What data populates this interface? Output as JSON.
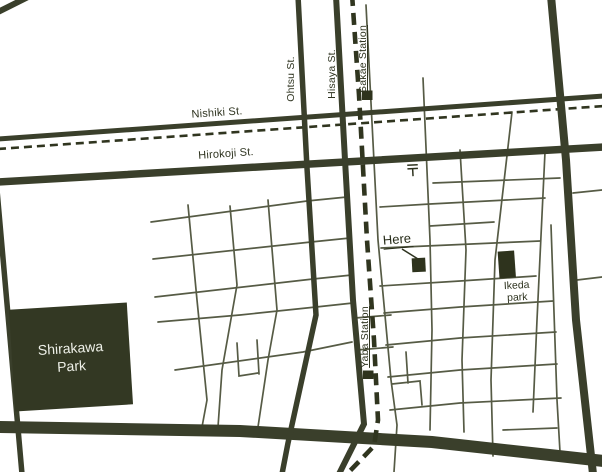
{
  "map": {
    "streets": {
      "nishiki": "Nishiki St.",
      "hirokoji": "Hirokoji St.",
      "ohtsu": "Ohtsu St.",
      "hisaya": "Hisaya St."
    },
    "stations": {
      "sakae": "Sakae Station",
      "yaba": "Yaba Station"
    },
    "labels": {
      "here": "Here",
      "ikeda_line1": "Ikeda",
      "ikeda_line2": "park",
      "shirakawa_line1": "Shirakawa",
      "shirakawa_line2": "Park"
    },
    "icons": {
      "post_office": "japanese-postal-mark"
    },
    "colors": {
      "road": "#3a3f2b",
      "thin_street": "#565b45",
      "subway_dashed": "#30351f",
      "marker_fill": "#2e331d",
      "park_fill": "#333823",
      "park_text": "#eef0e8",
      "text": "#2e331f",
      "background": "#ffffff"
    }
  }
}
